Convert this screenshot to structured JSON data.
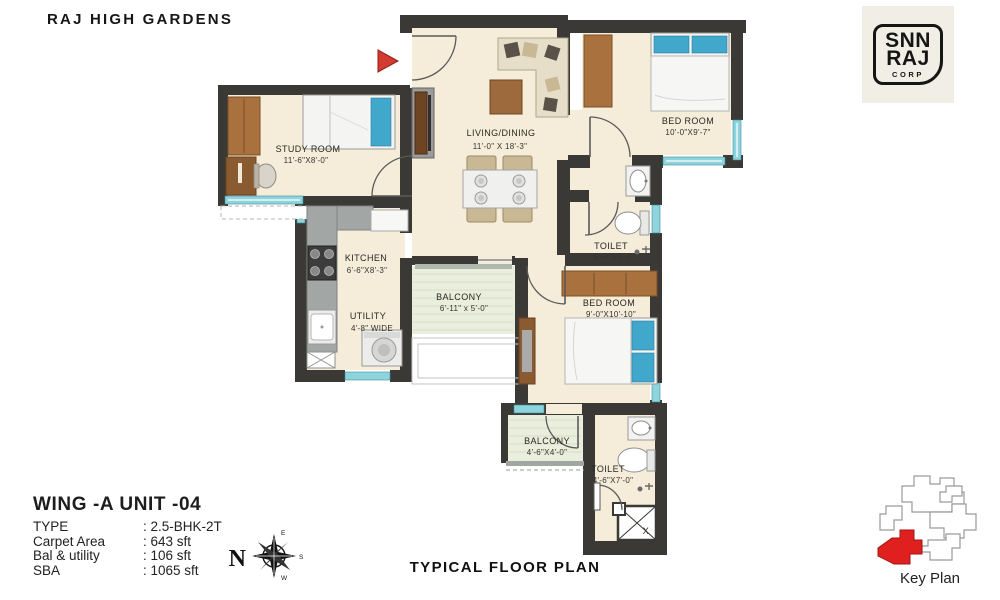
{
  "header": {
    "title": "RAJ HIGH GARDENS"
  },
  "logo": {
    "line1": "SNN",
    "line2": "RAJ",
    "line3": "CORP"
  },
  "plan": {
    "rooms": {
      "study": {
        "name": "STUDY ROOM",
        "dim": "11'-6\"X8'-0\""
      },
      "living": {
        "name": "LIVING/DINING",
        "dim": "11'-0\" X 18'-3\""
      },
      "bed1": {
        "name": "BED ROOM",
        "dim": "10'-0\"X9'-7\""
      },
      "toilet1": {
        "name": "TOILET",
        "dim": "5'-0\"X5'-1\""
      },
      "kitchen": {
        "name": "KITCHEN",
        "dim": "6'-6\"X8'-3\""
      },
      "utility": {
        "name": "UTILITY",
        "dim": "4'-8\" WIDE"
      },
      "balcony1": {
        "name": "BALCONY",
        "dim": "6'-11\" x 5'-0\""
      },
      "bed2": {
        "name": "BED ROOM",
        "dim": "9'-0\"X10'-10\""
      },
      "balcony2": {
        "name": "BALCONY",
        "dim": "4'-6\"X4'-0\""
      },
      "toilet2": {
        "name": "TOILET",
        "dim": "4'-6\"X7'-0\""
      }
    },
    "shaft_label": "X",
    "colors": {
      "wall": "#3a3936",
      "floor": "#f5ecd9",
      "window": "#8ed4dc",
      "entry_arrow": "#d43a2f",
      "key_highlight": "#e01f1f"
    }
  },
  "info": {
    "unit_title": "WING -A  UNIT -04",
    "rows": [
      {
        "label": "TYPE",
        "value": ": 2.5-BHK-2T"
      },
      {
        "label": "Carpet Area",
        "value": ": 643 sft"
      },
      {
        "label": "Bal & utility",
        "value": ": 106 sft"
      },
      {
        "label": "SBA",
        "value": ": 1065 sft"
      }
    ]
  },
  "compass": {
    "n": "N",
    "e": "E",
    "s": "S",
    "w": "W"
  },
  "footer": {
    "caption": "TYPICAL FLOOR PLAN"
  },
  "key_plan": {
    "label": "Key Plan"
  }
}
